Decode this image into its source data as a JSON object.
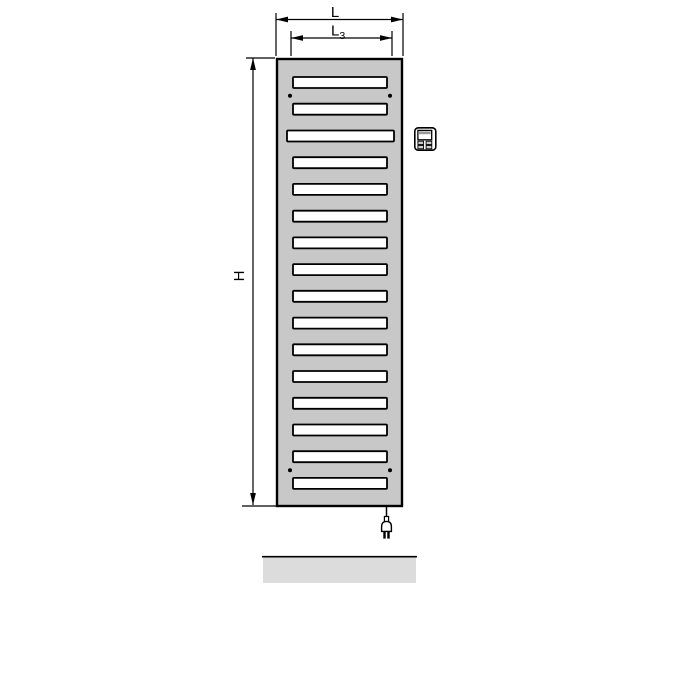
{
  "diagram": {
    "title": "radiator-technical-drawing",
    "background": "#ffffff",
    "line_color": "#000000"
  },
  "dimensions": {
    "width": {
      "label": "L"
    },
    "inner_width": {
      "label": "L",
      "sub": "3"
    },
    "height": {
      "label": "H"
    }
  },
  "radiator": {
    "fill": "#c8c8c8",
    "border_color": "#000000",
    "slat_fill": "#ffffff",
    "slat_count": 16,
    "wide_slat_index": 3,
    "mounting_hole_count": 4,
    "mounting_hole_color": "#000000"
  },
  "controller": {
    "icon": "heating-controller-icon",
    "body_fill": "#ffffff",
    "screen_strip_fill": "#999999",
    "button_fill": "#cccccc"
  },
  "power": {
    "icon": "power-plug-icon",
    "prong_count": 2
  },
  "floor": {
    "fill": "#dcdcdc",
    "edge_color": "#000000"
  }
}
